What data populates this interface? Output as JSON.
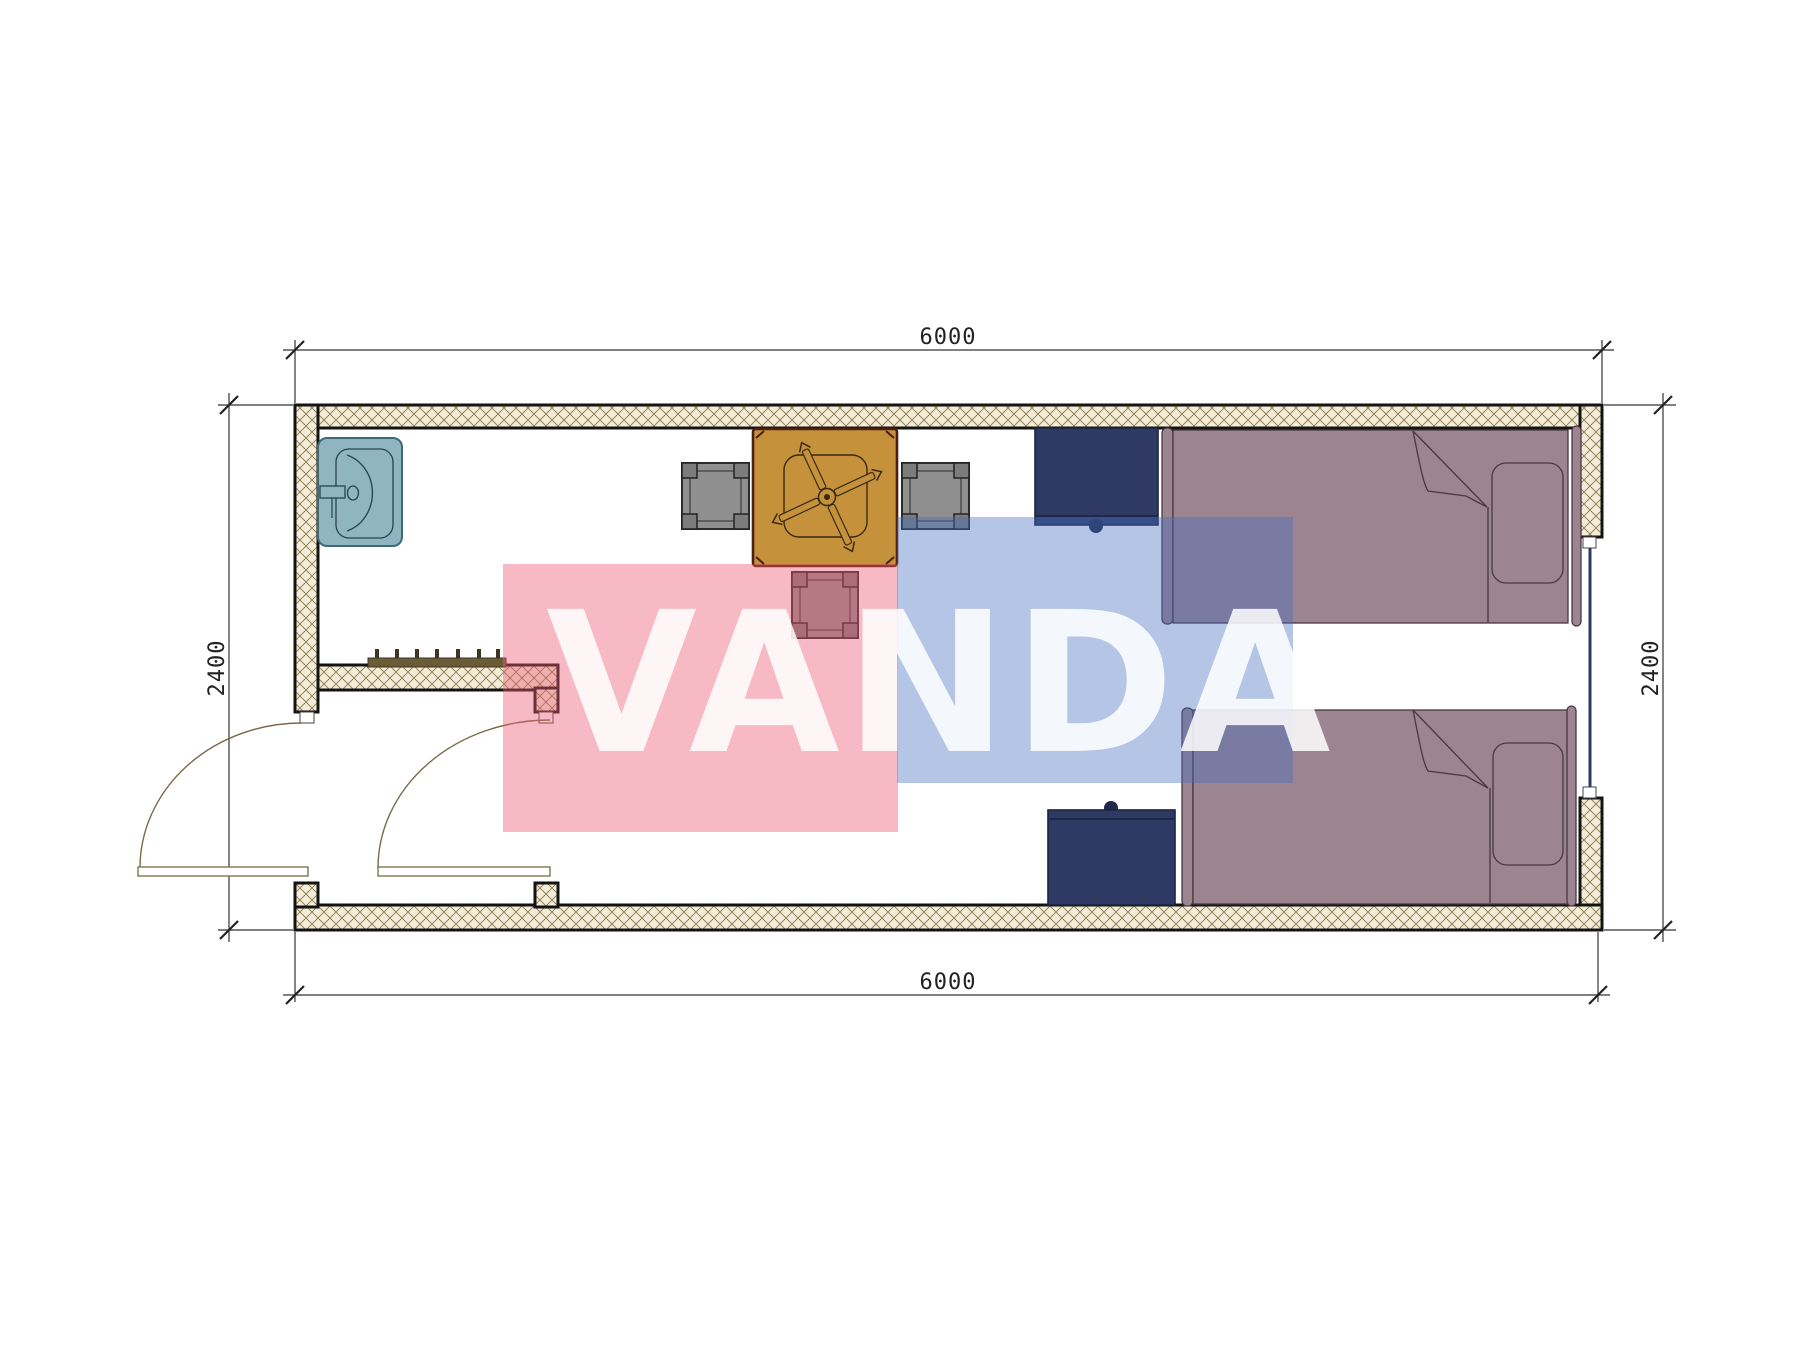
{
  "drawing": {
    "title": "container-room floor plan",
    "dimensions": {
      "top": "6000",
      "bottom": "6000",
      "left": "2400",
      "right": "2400"
    },
    "watermark": {
      "text": "VANDA",
      "pink": "#ec5a73",
      "blue": "#466ebe",
      "letter_color": "#ffffff"
    },
    "colors": {
      "wall_hatch_bg": "#f3ecd9",
      "wall_hatch_line": "#8a7a4a",
      "wall_outline": "#141414",
      "sink": "#8fb5c0",
      "sink_line": "#27444e",
      "table": "#c5913b",
      "table_line": "#3a2a12",
      "chair": "#8f8f8f",
      "chair_post": "#7c7c7c",
      "desk": "#2e3a64",
      "bed": "#9c8490",
      "bed_line": "#4a3842",
      "radiator": "#6b5c38",
      "door_arc": "#7a6a45",
      "window": "#2e3a64",
      "dim_line": "#333333"
    },
    "furniture": [
      {
        "name": "shower-sink",
        "room": "bathroom"
      },
      {
        "name": "coat-radiator",
        "room": "bathroom"
      },
      {
        "name": "ceiling-fan-table",
        "room": "living"
      },
      {
        "name": "chair-left",
        "room": "living"
      },
      {
        "name": "chair-right",
        "room": "living"
      },
      {
        "name": "chair-bottom",
        "room": "living"
      },
      {
        "name": "nightstand-top",
        "room": "living"
      },
      {
        "name": "nightstand-bottom",
        "room": "living"
      },
      {
        "name": "bed-top",
        "room": "living"
      },
      {
        "name": "bed-bottom",
        "room": "living"
      }
    ]
  }
}
